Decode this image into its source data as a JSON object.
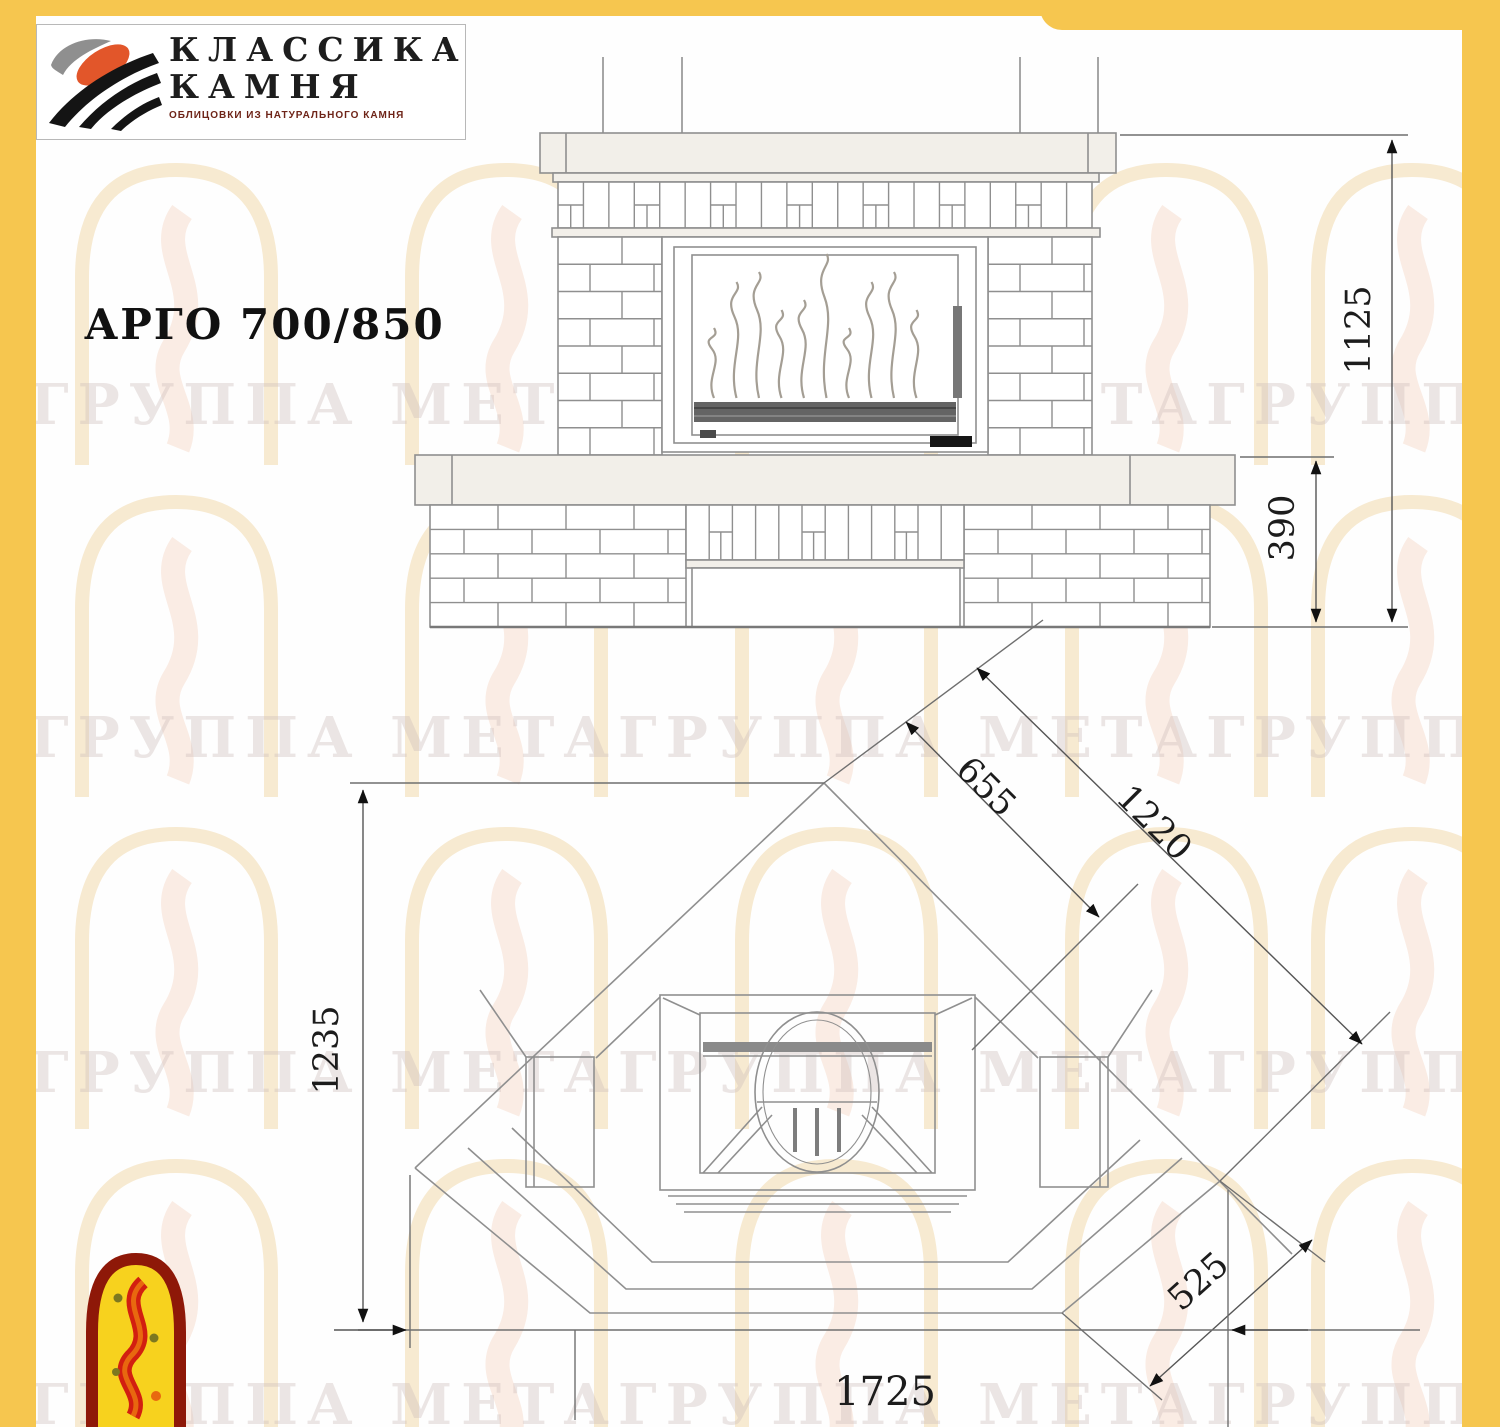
{
  "page_title": "АРГО 700/850",
  "brand": {
    "line1": "КЛАССИКА",
    "line2": "КАМНЯ",
    "tagline": "ОБЛИЦОВКИ ИЗ НАТУРАЛЬНОГО КАМНЯ"
  },
  "watermark": {
    "text": "ГРУППА МЕТАГРУППА МЕТАГРУППА МЕТА"
  },
  "views": {
    "front": {
      "label": "front-elevation",
      "dimensions": {
        "total_height": "1125",
        "base_height": "390"
      }
    },
    "plan": {
      "label": "plan-view",
      "dimensions": {
        "side_inner": "655",
        "side_full": "1220",
        "depth": "1235",
        "front_chamfer": "525",
        "total_width": "1725"
      }
    }
  },
  "colors": {
    "frame": "#f6c64f",
    "drawing_line": "#8f8f8f",
    "dimension_text": "#1c1c1c",
    "logo_orange": "#e2562a",
    "meta_red": "#c9230f",
    "meta_yellow": "#f7d21e"
  }
}
